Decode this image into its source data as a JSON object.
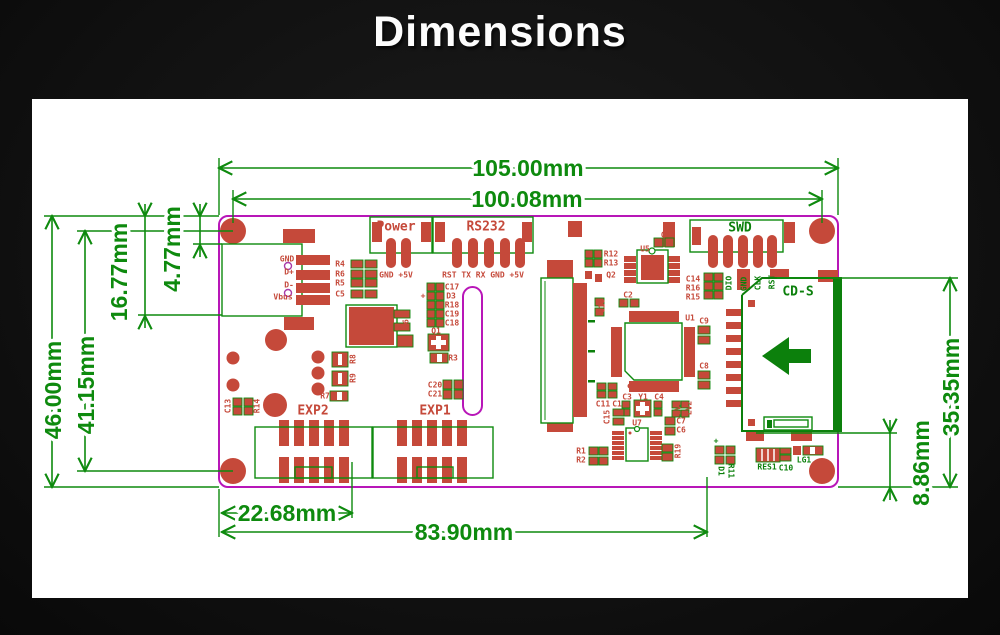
{
  "title": "Dimensions",
  "colors": {
    "background": "#121212",
    "panel": "#ffffff",
    "silkscreen_red": "#c5493a",
    "dimension_green": "#0e8a0e",
    "board_outline_magenta": "#b816b8",
    "usb_pin_purple": "#a83aa8"
  },
  "measurements_mm": [
    "105.00",
    "100.08",
    "46.00",
    "41.15",
    "16.77",
    "4.77",
    "35.35",
    "8.86",
    "22.68",
    "83.90"
  ],
  "dimensions": [
    {
      "t": "105.00mm",
      "x": 528,
      "y": 168,
      "k": "dim"
    },
    {
      "t": "100.08mm",
      "x": 527,
      "y": 199,
      "k": "dim"
    },
    {
      "t": "46.00mm",
      "x": 53,
      "y": 390,
      "r": -90,
      "k": "dim"
    },
    {
      "t": "41.15mm",
      "x": 86,
      "y": 385,
      "r": -90,
      "k": "dim"
    },
    {
      "t": "16.77mm",
      "x": 119,
      "y": 272,
      "r": -90,
      "k": "dim"
    },
    {
      "t": "4.77mm",
      "x": 172,
      "y": 249,
      "r": -90,
      "k": "dim"
    },
    {
      "t": "35.35mm",
      "x": 951,
      "y": 387,
      "r": -90,
      "k": "dim"
    },
    {
      "t": "8.86mm",
      "x": 921,
      "y": 463,
      "r": -90,
      "k": "dim"
    },
    {
      "t": "22.68mm",
      "x": 287,
      "y": 513,
      "k": "dim"
    },
    {
      "t": "83.90mm",
      "x": 464,
      "y": 532,
      "k": "dim"
    }
  ],
  "labels": [
    {
      "t": "Power",
      "x": 396,
      "y": 227,
      "k": "conn"
    },
    {
      "t": "RS232",
      "x": 486,
      "y": 227,
      "k": "conn"
    },
    {
      "t": "SWD",
      "x": 740,
      "y": 228,
      "k": "conng"
    },
    {
      "t": "EXP2",
      "x": 313,
      "y": 411,
      "k": "conn"
    },
    {
      "t": "EXP1",
      "x": 435,
      "y": 411,
      "k": "conn"
    },
    {
      "t": "CD-S",
      "x": 798,
      "y": 292,
      "k": "conng"
    },
    {
      "t": "GND +5V",
      "x": 396,
      "y": 275,
      "k": "pin"
    },
    {
      "t": "RST TX RX GND +5V",
      "x": 483,
      "y": 275,
      "k": "pin"
    },
    {
      "t": "GND",
      "x": 287,
      "y": 259,
      "k": "pin"
    },
    {
      "t": "D+",
      "x": 289,
      "y": 272,
      "k": "pin"
    },
    {
      "t": "D-",
      "x": 289,
      "y": 285,
      "k": "pin"
    },
    {
      "t": "Vbus",
      "x": 283,
      "y": 297,
      "k": "pin"
    },
    {
      "t": "DIO",
      "x": 729,
      "y": 283,
      "r": -90,
      "k": "ping"
    },
    {
      "t": "GND",
      "x": 744,
      "y": 284,
      "r": -90,
      "k": "ping"
    },
    {
      "t": "CLK",
      "x": 758,
      "y": 283,
      "r": -90,
      "k": "ping"
    },
    {
      "t": "RST",
      "x": 772,
      "y": 282,
      "r": -90,
      "k": "ping"
    },
    {
      "t": "RES1",
      "x": 767,
      "y": 467,
      "k": "refg"
    },
    {
      "t": "C10",
      "x": 786,
      "y": 468,
      "k": "refg"
    },
    {
      "t": "LG1",
      "x": 804,
      "y": 460,
      "k": "refg"
    },
    {
      "t": "D1",
      "x": 721,
      "y": 471,
      "r": 90,
      "k": "refg"
    },
    {
      "t": "R11",
      "x": 731,
      "y": 471,
      "r": 90,
      "k": "refg"
    },
    {
      "t": "+",
      "x": 716,
      "y": 441,
      "k": "refg"
    },
    {
      "t": "R4",
      "x": 340,
      "y": 264,
      "k": "ref"
    },
    {
      "t": "R6",
      "x": 340,
      "y": 274,
      "k": "ref"
    },
    {
      "t": "R5",
      "x": 340,
      "y": 283,
      "k": "ref"
    },
    {
      "t": "C5",
      "x": 340,
      "y": 294,
      "k": "ref"
    },
    {
      "t": "+",
      "x": 423,
      "y": 296,
      "k": "ref"
    },
    {
      "t": "C17",
      "x": 452,
      "y": 287,
      "k": "ref"
    },
    {
      "t": "D3",
      "x": 451,
      "y": 296,
      "k": "ref"
    },
    {
      "t": "R18",
      "x": 452,
      "y": 305,
      "k": "ref"
    },
    {
      "t": "C19",
      "x": 452,
      "y": 314,
      "k": "ref"
    },
    {
      "t": "C18",
      "x": 452,
      "y": 323,
      "k": "ref"
    },
    {
      "t": "Q1",
      "x": 436,
      "y": 331,
      "k": "ref"
    },
    {
      "t": "R3",
      "x": 453,
      "y": 358,
      "k": "ref"
    },
    {
      "t": "C20",
      "x": 435,
      "y": 385,
      "k": "ref"
    },
    {
      "t": "C21",
      "x": 435,
      "y": 394,
      "k": "ref"
    },
    {
      "t": "U6",
      "x": 406,
      "y": 324,
      "r": -90,
      "k": "ref"
    },
    {
      "t": "R8",
      "x": 353,
      "y": 359,
      "r": -90,
      "k": "ref"
    },
    {
      "t": "R9",
      "x": 353,
      "y": 378,
      "r": -90,
      "k": "ref"
    },
    {
      "t": "R7",
      "x": 325,
      "y": 396,
      "k": "ref"
    },
    {
      "t": "C13",
      "x": 228,
      "y": 406,
      "r": -90,
      "k": "ref"
    },
    {
      "t": "R14",
      "x": 257,
      "y": 406,
      "r": -90,
      "k": "ref"
    },
    {
      "t": "R12",
      "x": 611,
      "y": 254,
      "k": "ref"
    },
    {
      "t": "R13",
      "x": 611,
      "y": 263,
      "k": "ref"
    },
    {
      "t": "Q2",
      "x": 611,
      "y": 275,
      "k": "ref"
    },
    {
      "t": "C16",
      "x": 602,
      "y": 306,
      "r": -90,
      "k": "ref"
    },
    {
      "t": "C2",
      "x": 628,
      "y": 295,
      "k": "ref"
    },
    {
      "t": "C12",
      "x": 668,
      "y": 235,
      "k": "ref"
    },
    {
      "t": "U5",
      "x": 645,
      "y": 249,
      "k": "ref"
    },
    {
      "t": "C14",
      "x": 693,
      "y": 279,
      "k": "ref"
    },
    {
      "t": "R16",
      "x": 693,
      "y": 288,
      "k": "ref"
    },
    {
      "t": "R15",
      "x": 693,
      "y": 297,
      "k": "ref"
    },
    {
      "t": "40",
      "x": 579,
      "y": 289,
      "r": -90,
      "k": "ref"
    },
    {
      "t": "1",
      "x": 579,
      "y": 410,
      "r": -90,
      "k": "ref"
    },
    {
      "t": "U1",
      "x": 690,
      "y": 318,
      "k": "ref"
    },
    {
      "t": "C9",
      "x": 704,
      "y": 321,
      "k": "ref"
    },
    {
      "t": "C8",
      "x": 704,
      "y": 366,
      "k": "ref"
    },
    {
      "t": "C11",
      "x": 603,
      "y": 404,
      "k": "ref"
    },
    {
      "t": "C1",
      "x": 617,
      "y": 404,
      "k": "ref"
    },
    {
      "t": "C3",
      "x": 627,
      "y": 397,
      "k": "ref"
    },
    {
      "t": "Y1",
      "x": 643,
      "y": 397,
      "k": "ref"
    },
    {
      "t": "C4",
      "x": 659,
      "y": 397,
      "k": "ref"
    },
    {
      "t": "LV1",
      "x": 678,
      "y": 408,
      "r": -90,
      "k": "ref"
    },
    {
      "t": "LV2",
      "x": 689,
      "y": 408,
      "r": -90,
      "k": "ref"
    },
    {
      "t": "C15",
      "x": 607,
      "y": 417,
      "r": -90,
      "k": "ref"
    },
    {
      "t": "U7",
      "x": 637,
      "y": 423,
      "k": "ref"
    },
    {
      "t": "C7",
      "x": 681,
      "y": 421,
      "k": "ref"
    },
    {
      "t": "C6",
      "x": 681,
      "y": 430,
      "k": "ref"
    },
    {
      "t": "R1",
      "x": 581,
      "y": 451,
      "k": "ref"
    },
    {
      "t": "R2",
      "x": 581,
      "y": 460,
      "k": "ref"
    },
    {
      "t": "R19",
      "x": 678,
      "y": 451,
      "r": -90,
      "k": "ref"
    }
  ]
}
